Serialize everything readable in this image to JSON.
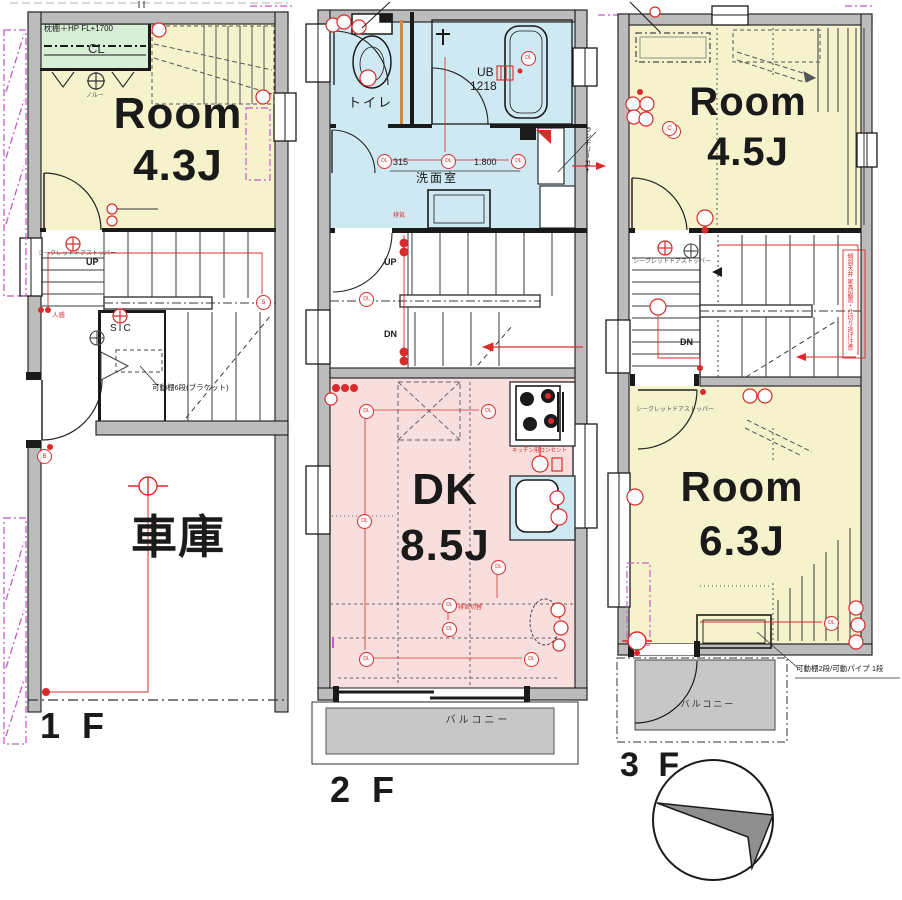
{
  "floor_labels": {
    "f1": "1 F",
    "f2": "2 F",
    "f3": "3 F"
  },
  "rooms": {
    "room_1f": {
      "name": "Room",
      "size": "4.3J"
    },
    "garage": "車庫",
    "dk": {
      "name": "DK",
      "size": "8.5J"
    },
    "room_3f_upper": {
      "name": "Room",
      "size": "4.5J"
    },
    "room_3f_lower": {
      "name": "Room",
      "size": "6.3J"
    },
    "toilet": "トイレ",
    "washroom": "洗面室",
    "unit_bath": {
      "name": "UB",
      "size": "1218"
    },
    "balcony_2f": "バルコニー",
    "balcony_3f": "バルコニー",
    "closet": "CL",
    "shoe_closet": "SIC"
  },
  "stair_labels": {
    "up_1f": "UP",
    "up_2f": "UP",
    "dn_2f": "DN",
    "dn_3f": "DN"
  },
  "dimensions": {
    "washroom_depth": "315",
    "washroom_width": "1.800"
  },
  "annotations": {
    "closet_shelf": "枕棚＋HP FL+1700",
    "movable_shelf_1f": "可動棚6段(ブラケット)",
    "movable_shelf_3f": "可動棚2段/可動パイプ 1段",
    "door_stopper_1f": "シークレットドアストッパー",
    "door_stopper_3f_upper": "シークレットドアストッパー",
    "door_stopper_3f_lower": "シークレットドアストッパー",
    "laundry": "ランドリー FL+",
    "kitchen_outlet": "キッチン用コンセント",
    "exhaust": "排気",
    "exhaust_switch": "排気切替",
    "motion_sensor": "人感",
    "hanger_note": "ノルー",
    "sloped_ceiling_note": "傾斜天井 家具設置・仕切り逃げ注意"
  },
  "symbols": {
    "downlight": "DL",
    "mark_b": "B",
    "mark_c": "C",
    "mark_5": "5"
  },
  "colors": {
    "room_yellow": "#f5f2cc",
    "water_blue": "#cfe9f2",
    "dk_pink": "#f8dfdd",
    "closet_green": "#d7eed7",
    "balcony_gray": "#c7c7c7",
    "wall_gray": "#bcbcbc",
    "accent_red": "#d92b2b",
    "accent_magenta": "#c85ac8",
    "accent_orange": "#d4883c"
  }
}
